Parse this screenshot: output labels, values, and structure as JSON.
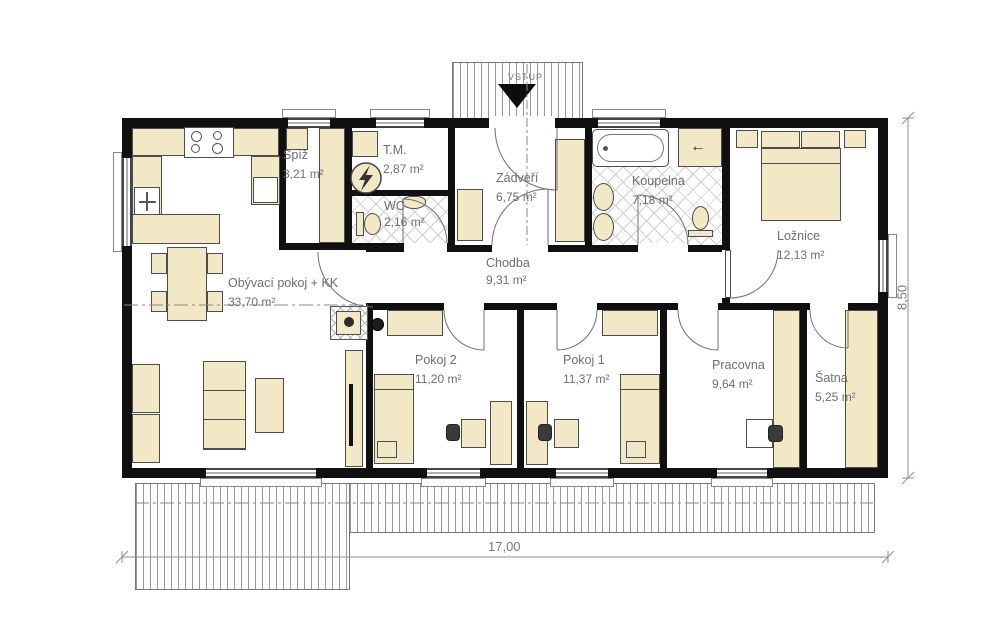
{
  "entrance": {
    "label": "VSTUP"
  },
  "rooms": [
    {
      "key": "living",
      "name": "Obývací pokoj + KK",
      "area": "33,70 m²"
    },
    {
      "key": "spiz",
      "name": "Spíž",
      "area": "3,21 m²"
    },
    {
      "key": "tm",
      "name": "T.M.",
      "area": "2,87 m²"
    },
    {
      "key": "wc",
      "name": "WC",
      "area": "2,16 m²"
    },
    {
      "key": "zadveri",
      "name": "Zádveří",
      "area": "6,75 m²"
    },
    {
      "key": "koupelna",
      "name": "Koupelna",
      "area": "7,18 m²"
    },
    {
      "key": "loznice",
      "name": "Ložnice",
      "area": "12,13 m²"
    },
    {
      "key": "chodba",
      "name": "Chodba",
      "area": "9,31 m²"
    },
    {
      "key": "pokoj2",
      "name": "Pokoj 2",
      "area": "11,20 m²"
    },
    {
      "key": "pokoj1",
      "name": "Pokoj 1",
      "area": "11,37 m²"
    },
    {
      "key": "pracovna",
      "name": "Pracovna",
      "area": "9,64 m²"
    },
    {
      "key": "satna",
      "name": "Šatna",
      "area": "5,25 m²"
    }
  ],
  "dimensions": {
    "width_label": "17,00",
    "height_label": "8,50"
  },
  "icons": {
    "closet_arrow": "←"
  },
  "colors": {
    "wall": "#101010",
    "furniture": "#f2e8c6",
    "label": "#6e6e6e"
  }
}
